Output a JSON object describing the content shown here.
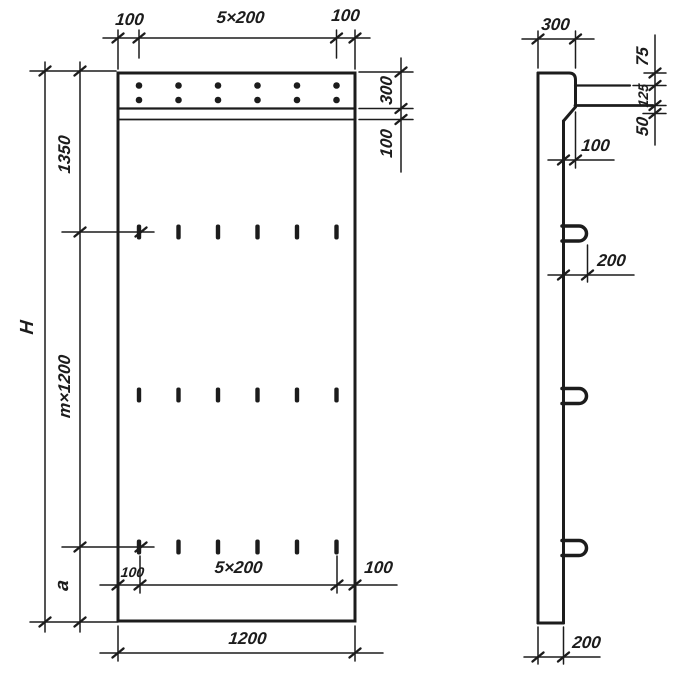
{
  "drawing_type": "panel-technical-drawing",
  "colors": {
    "ink": "#1c1c1c",
    "paper": "#ffffff"
  },
  "front": {
    "dim_top_left": "100",
    "dim_top_span": "5×200",
    "dim_top_right": "100",
    "dim_height_total": "H",
    "dim_height_top": "1350",
    "dim_height_mid": "m×1200",
    "dim_height_bottom": "a",
    "dim_band_height": "300",
    "dim_band_strip": "100",
    "dim_bottom_left": "100",
    "dim_bottom_span": "5×200",
    "dim_bottom_right": "100",
    "dim_width_total": "1200"
  },
  "side": {
    "dim_top_width": "300",
    "dim_chain_top": "75",
    "dim_chain_mid": "125",
    "dim_chain_bottom": "50",
    "dim_overhang": "100",
    "dim_loop_length": "200",
    "dim_thickness": "200"
  }
}
